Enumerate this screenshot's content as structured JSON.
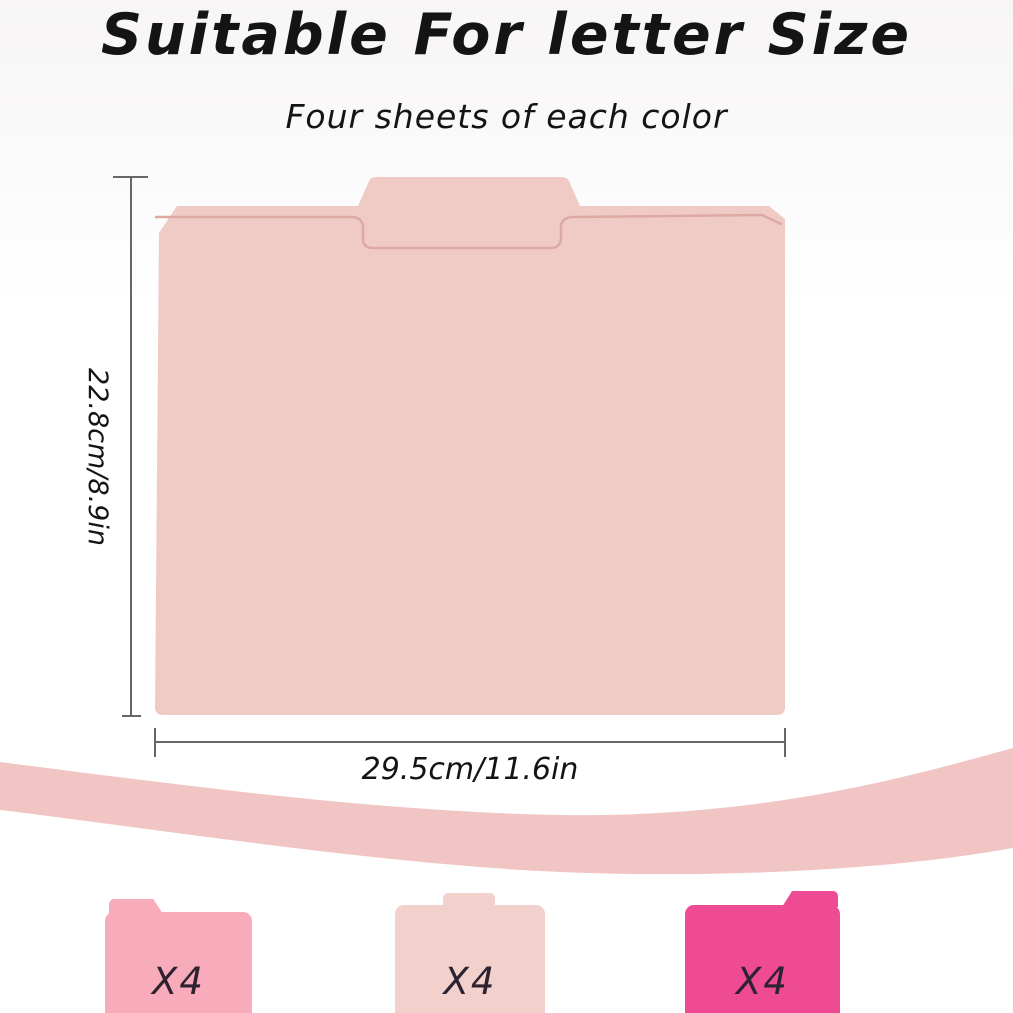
{
  "header": {
    "title": "Suitable For letter Size",
    "subtitle": "Four sheets of each color"
  },
  "size_diagram": {
    "height_label": "22.8cm/8.9in",
    "width_label": "29.5cm/11.6in"
  },
  "variants": [
    {
      "name": "pink",
      "count_label": "X4",
      "color": "#f8acbb",
      "tab_position": "left"
    },
    {
      "name": "blush",
      "count_label": "X4",
      "color": "#f2d0cb",
      "tab_position": "center"
    },
    {
      "name": "hot-pink",
      "count_label": "X4",
      "color": "#ee4b93",
      "tab_position": "right"
    }
  ],
  "colors": {
    "main_folder": "#f0cbc6",
    "folder_seam": "#dcaaa2",
    "wave": "#f2c5c5",
    "dimension_line": "#666666"
  }
}
